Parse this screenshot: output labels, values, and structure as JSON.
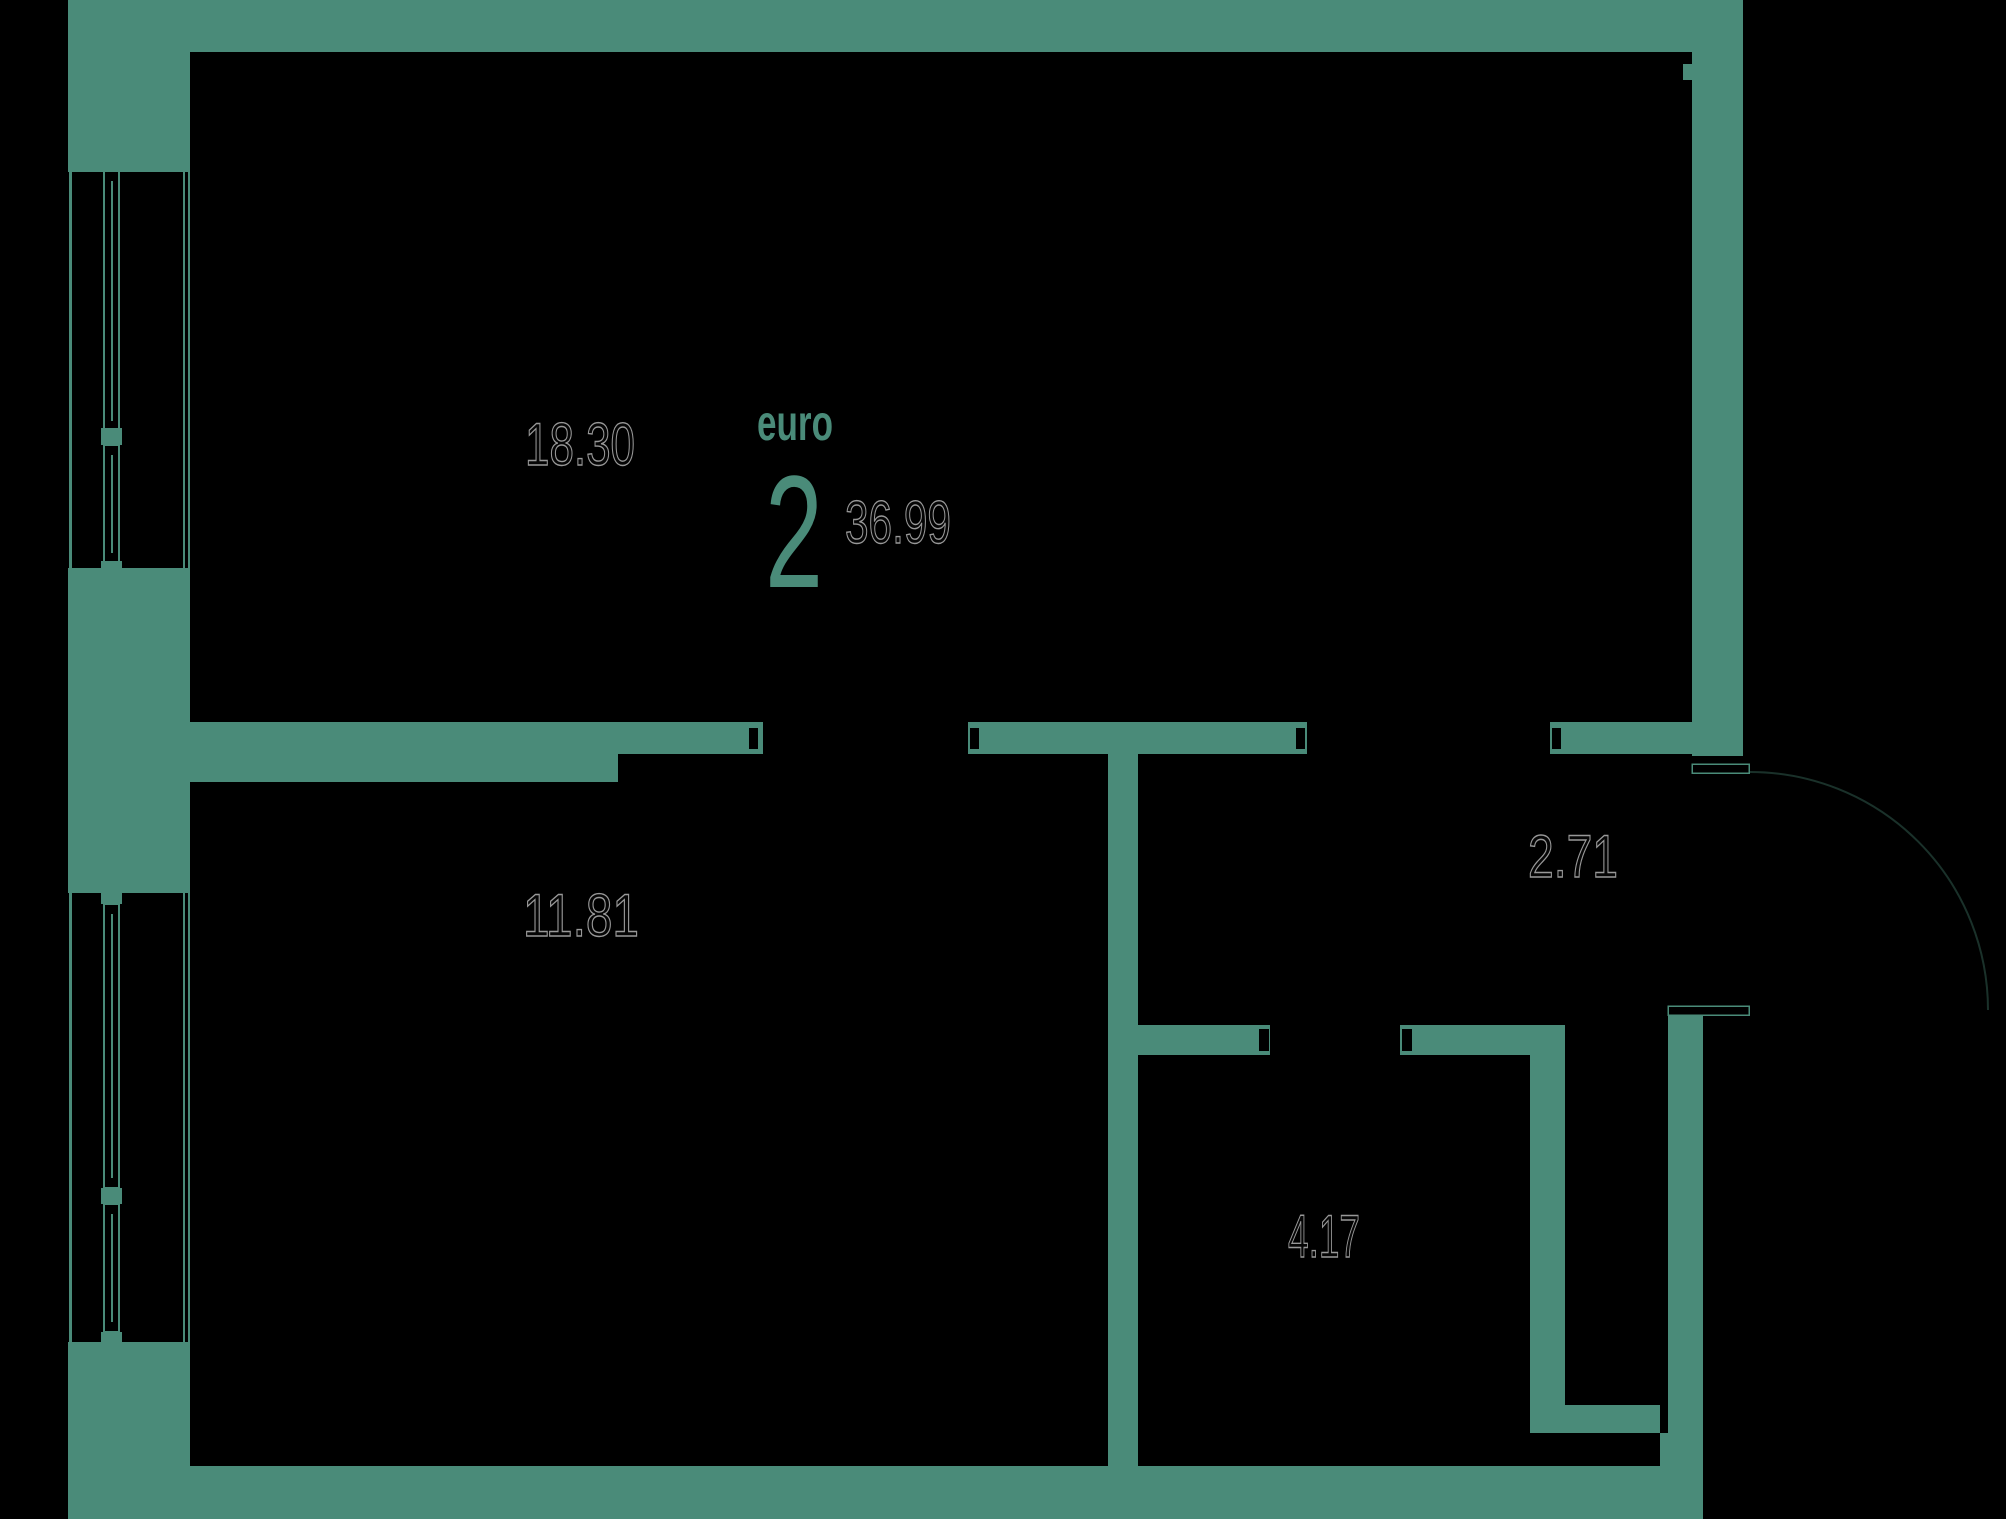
{
  "canvas": {
    "width": 2006,
    "height": 1519
  },
  "colors": {
    "background": "#000000",
    "wall": "#4a8b79",
    "label_fill": "#050505",
    "label_outline": "#989898",
    "accent": "#4a8b79"
  },
  "plan": {
    "logo": {
      "label": "euro",
      "rooms_count": "2",
      "total_area": "36.99"
    },
    "rooms": [
      {
        "name": "room-top",
        "area": "18.30"
      },
      {
        "name": "room-bottom",
        "area": "11.81"
      },
      {
        "name": "hallway",
        "area": "2.71"
      },
      {
        "name": "bathroom",
        "area": "4.17"
      }
    ]
  },
  "labels": [
    {
      "name": "area-label-room-top",
      "bind": "plan.rooms.0.area",
      "x": 525,
      "baseline": 465,
      "size": 60,
      "length": 110,
      "style": "outline"
    },
    {
      "name": "area-label-room-bottom",
      "bind": "plan.rooms.1.area",
      "x": 523,
      "baseline": 936,
      "size": 60,
      "length": 116,
      "style": "outline"
    },
    {
      "name": "area-label-hallway",
      "bind": "plan.rooms.2.area",
      "x": 1528,
      "baseline": 877,
      "size": 60,
      "length": 90,
      "style": "outline"
    },
    {
      "name": "area-label-bathroom",
      "bind": "plan.rooms.3.area",
      "x": 1288,
      "baseline": 1257,
      "size": 60,
      "length": 72,
      "style": "outline"
    },
    {
      "name": "logo-type-label",
      "bind": "plan.logo.label",
      "x": 757,
      "baseline": 440,
      "size": 50,
      "length": 76,
      "style": "accent-bold"
    },
    {
      "name": "logo-rooms-count",
      "bind": "plan.logo.rooms_count",
      "x": 765,
      "baseline": 587,
      "size": 160,
      "length": 58,
      "style": "accent-big"
    },
    {
      "name": "logo-total-area",
      "bind": "plan.logo.total_area",
      "x": 845,
      "baseline": 543,
      "size": 60,
      "length": 106,
      "style": "outline"
    }
  ],
  "floorplan": {
    "walls": [
      {
        "name": "wall-top",
        "x": 68,
        "y": 0,
        "w": 1675,
        "h": 52
      },
      {
        "name": "wall-right-upper",
        "x": 1692,
        "y": 0,
        "w": 51,
        "h": 756
      },
      {
        "name": "wall-right-tick",
        "x": 1683,
        "y": 64,
        "w": 9,
        "h": 16
      },
      {
        "name": "wall-left-top",
        "x": 68,
        "y": 0,
        "w": 122,
        "h": 172
      },
      {
        "name": "wall-left-middle",
        "x": 68,
        "y": 568,
        "w": 122,
        "h": 325
      },
      {
        "name": "wall-left-bottom",
        "x": 68,
        "y": 1342,
        "w": 122,
        "h": 177
      },
      {
        "name": "wall-bottom",
        "x": 190,
        "y": 1466,
        "w": 1513,
        "h": 53
      },
      {
        "name": "wall-right-lower",
        "x": 1668,
        "y": 1014,
        "w": 35,
        "h": 505
      },
      {
        "name": "wall-interior-horizontal-thick",
        "x": 183,
        "y": 722,
        "w": 435,
        "h": 60
      },
      {
        "name": "wall-interior-horizontal-a",
        "x": 618,
        "y": 722,
        "w": 145,
        "h": 32
      },
      {
        "name": "wall-interior-horizontal-b",
        "x": 968,
        "y": 722,
        "w": 339,
        "h": 32
      },
      {
        "name": "wall-interior-horizontal-c",
        "x": 1550,
        "y": 722,
        "w": 142,
        "h": 32
      },
      {
        "name": "wall-interior-vertical",
        "x": 1108,
        "y": 754,
        "w": 30,
        "h": 712
      },
      {
        "name": "wall-bathroom-top-left",
        "x": 1138,
        "y": 1025,
        "w": 132,
        "h": 30
      },
      {
        "name": "wall-bathroom-top-right",
        "x": 1400,
        "y": 1025,
        "w": 130,
        "h": 30
      },
      {
        "name": "wall-bathroom-partition",
        "x": 1530,
        "y": 1025,
        "w": 35,
        "h": 408
      },
      {
        "name": "wall-niche-stub",
        "x": 1530,
        "y": 1405,
        "w": 130,
        "h": 28
      },
      {
        "name": "wall-niche-post",
        "x": 1660,
        "y": 1433,
        "w": 8,
        "h": 33
      },
      {
        "name": "window1-mullion",
        "x": 101,
        "y": 428,
        "w": 21,
        "h": 17
      },
      {
        "name": "window1-sill-block",
        "x": 101,
        "y": 561,
        "w": 21,
        "h": 17
      },
      {
        "name": "window2-head-block",
        "x": 101,
        "y": 887,
        "w": 21,
        "h": 17
      },
      {
        "name": "window2-mullion",
        "x": 101,
        "y": 1188,
        "w": 21,
        "h": 16
      },
      {
        "name": "window2-sill-block",
        "x": 101,
        "y": 1332,
        "w": 21,
        "h": 16
      }
    ],
    "window_lines": [
      {
        "name": "window1-outer-line",
        "x": 69,
        "y": 172,
        "w": 3,
        "h": 396
      },
      {
        "name": "window1-inner-line-a",
        "x": 183,
        "y": 172,
        "w": 2,
        "h": 396
      },
      {
        "name": "window1-inner-line-b",
        "x": 188,
        "y": 172,
        "w": 2,
        "h": 396
      },
      {
        "name": "window1-sash-line-upper",
        "x": 111,
        "y": 181,
        "w": 2,
        "h": 240
      },
      {
        "name": "window1-sash-line-lower",
        "x": 111,
        "y": 455,
        "w": 2,
        "h": 98
      },
      {
        "name": "window2-outer-line",
        "x": 69,
        "y": 893,
        "w": 3,
        "h": 449
      },
      {
        "name": "window2-inner-line-a",
        "x": 183,
        "y": 893,
        "w": 2,
        "h": 449
      },
      {
        "name": "window2-inner-line-b",
        "x": 188,
        "y": 893,
        "w": 2,
        "h": 449
      },
      {
        "name": "window2-sash-line-upper",
        "x": 111,
        "y": 914,
        "w": 2,
        "h": 264
      },
      {
        "name": "window2-sash-line-lower",
        "x": 111,
        "y": 1214,
        "w": 2,
        "h": 108
      }
    ],
    "window_frames": [
      {
        "name": "window1-frame-upper",
        "x": 104,
        "y": 169,
        "w": 15,
        "h": 260
      },
      {
        "name": "window1-frame-lower",
        "x": 104,
        "y": 445,
        "w": 15,
        "h": 117
      },
      {
        "name": "window2-frame-upper",
        "x": 104,
        "y": 904,
        "w": 15,
        "h": 284
      },
      {
        "name": "window2-frame-lower",
        "x": 104,
        "y": 1204,
        "w": 15,
        "h": 128
      }
    ],
    "door_jambs": [
      {
        "name": "jamb-door1-left",
        "x": 749,
        "y": 728,
        "w": 9,
        "h": 21
      },
      {
        "name": "jamb-door1-right",
        "x": 970,
        "y": 728,
        "w": 9,
        "h": 21
      },
      {
        "name": "jamb-door2-left",
        "x": 1296,
        "y": 728,
        "w": 9,
        "h": 21
      },
      {
        "name": "jamb-door2-right",
        "x": 1552,
        "y": 728,
        "w": 9,
        "h": 21
      },
      {
        "name": "jamb-bath-left",
        "x": 1259,
        "y": 1029,
        "w": 10,
        "h": 22
      },
      {
        "name": "jamb-bath-right",
        "x": 1402,
        "y": 1029,
        "w": 10,
        "h": 22
      }
    ],
    "thresholds": [
      {
        "name": "entry-threshold-top",
        "x": 1692,
        "y": 764,
        "w": 57,
        "h": 9
      },
      {
        "name": "entry-threshold-bottom",
        "x": 1668,
        "y": 1006,
        "w": 81,
        "h": 9
      }
    ],
    "door_arc": {
      "name": "entry-door-swing",
      "path": "M 1750 772 A 238 238 0 0 1 1988 1010"
    }
  }
}
